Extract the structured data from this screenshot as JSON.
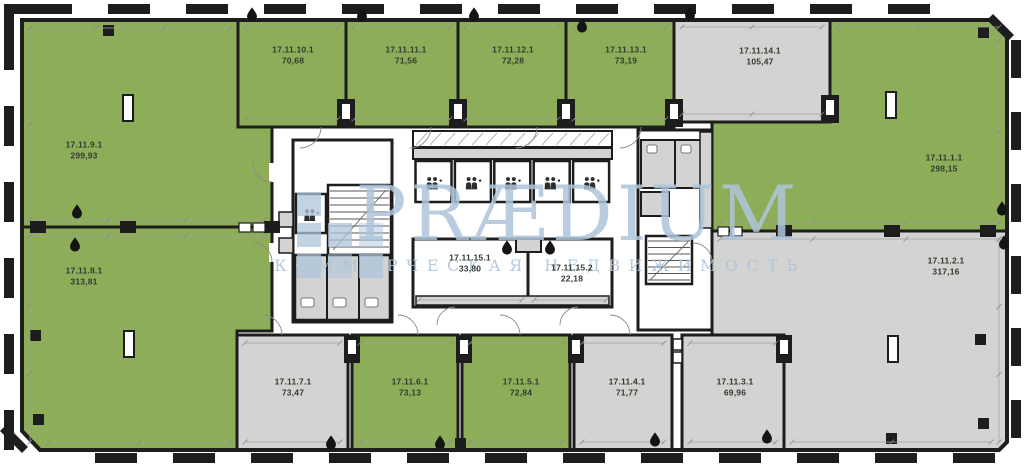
{
  "watermark": {
    "brand": "PRÆDIUM",
    "tagline": "КОММЕРЧЕСКАЯ НЕДВИЖИМОСТЬ",
    "logo_icon": "praedium-squares-logo"
  },
  "colors": {
    "available": "#8dad58",
    "unavailable": "#d3d3d1",
    "core_room": "#ffffff",
    "wall": "#1d1d1d",
    "watermark": "#aec5db",
    "label": "#343a34"
  },
  "icons": {
    "wet_point": "water-drop",
    "elevator_cabin": "people-pair",
    "stairwell": "stair-treads"
  },
  "units": [
    {
      "id": "17.11.1.1",
      "area": "298,15",
      "status": "available"
    },
    {
      "id": "17.11.2.1",
      "area": "317,16",
      "status": "unavailable"
    },
    {
      "id": "17.11.3.1",
      "area": "69,96",
      "status": "unavailable"
    },
    {
      "id": "17.11.4.1",
      "area": "71,77",
      "status": "unavailable"
    },
    {
      "id": "17.11.5.1",
      "area": "72,84",
      "status": "available"
    },
    {
      "id": "17.11.6.1",
      "area": "73,13",
      "status": "available"
    },
    {
      "id": "17.11.7.1",
      "area": "73,47",
      "status": "unavailable"
    },
    {
      "id": "17.11.8.1",
      "area": "313,81",
      "status": "available"
    },
    {
      "id": "17.11.9.1",
      "area": "299,93",
      "status": "available"
    },
    {
      "id": "17.11.10.1",
      "area": "70,68",
      "status": "available"
    },
    {
      "id": "17.11.11.1",
      "area": "71,56",
      "status": "available"
    },
    {
      "id": "17.11.12.1",
      "area": "72,28",
      "status": "available"
    },
    {
      "id": "17.11.13.1",
      "area": "73,19",
      "status": "available"
    },
    {
      "id": "17.11.14.1",
      "area": "105,47",
      "status": "unavailable"
    },
    {
      "id": "17.11.15.1",
      "area": "33,80",
      "status": "core"
    },
    {
      "id": "17.11.15.2",
      "area": "22,18",
      "status": "core"
    }
  ]
}
